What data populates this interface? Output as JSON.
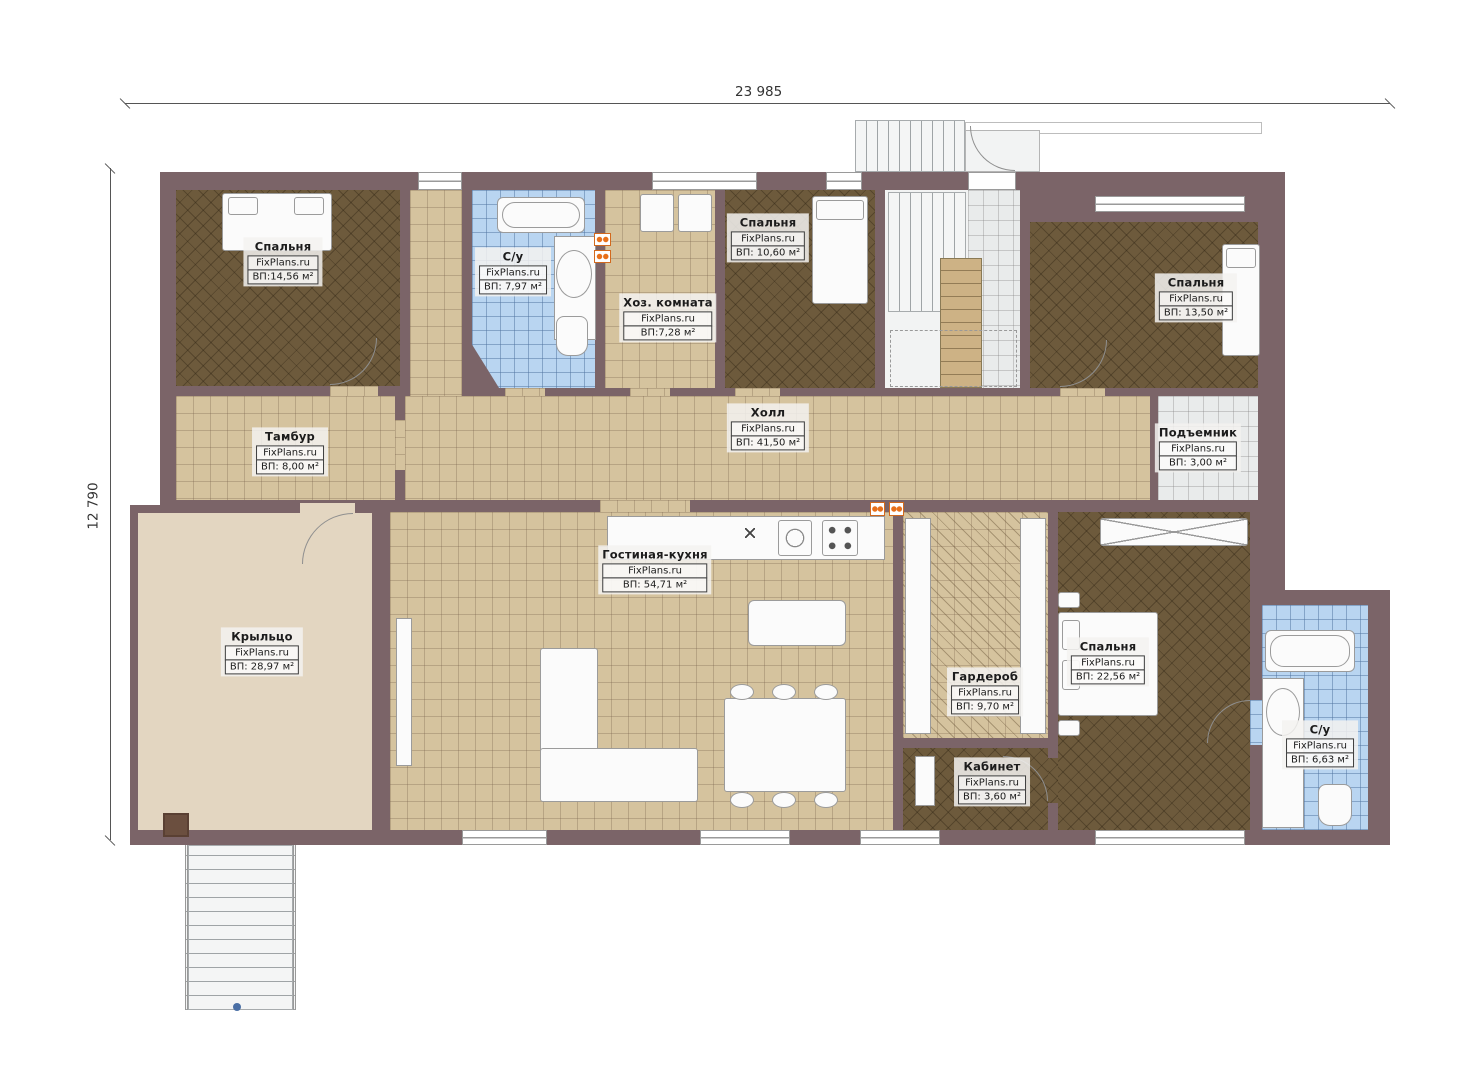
{
  "dimensions": {
    "width_label": "23 985",
    "height_label": "12 790"
  },
  "rooms": [
    {
      "name": "Спальня",
      "site": "FixPlans.ru",
      "area": "ВП:14,56 м²"
    },
    {
      "name": "С/у",
      "site": "FixPlans.ru",
      "area": "ВП: 7,97 м²"
    },
    {
      "name": "Хоз. комната",
      "site": "FixPlans.ru",
      "area": "ВП:7,28 м²"
    },
    {
      "name": "Спальня",
      "site": "FixPlans.ru",
      "area": "ВП: 10,60 м²"
    },
    {
      "name": "Спальня",
      "site": "FixPlans.ru",
      "area": "ВП: 13,50 м²"
    },
    {
      "name": "Тамбур",
      "site": "FixPlans.ru",
      "area": "ВП: 8,00 м²"
    },
    {
      "name": "Холл",
      "site": "FixPlans.ru",
      "area": "ВП: 41,50 м²"
    },
    {
      "name": "Подъемник",
      "site": "FixPlans.ru",
      "area": "ВП: 3,00 м²"
    },
    {
      "name": "Крыльцо",
      "site": "FixPlans.ru",
      "area": "ВП: 28,97 м²"
    },
    {
      "name": "Гостиная-кухня",
      "site": "FixPlans.ru",
      "area": "ВП: 54,71 м²"
    },
    {
      "name": "Гардероб",
      "site": "FixPlans.ru",
      "area": "ВП: 9,70 м²"
    },
    {
      "name": "Кабинет",
      "site": "FixPlans.ru",
      "area": "ВП: 3,60 м²"
    },
    {
      "name": "Спальня",
      "site": "FixPlans.ru",
      "area": "ВП: 22,56 м²"
    },
    {
      "name": "С/у",
      "site": "FixPlans.ru",
      "area": "ВП: 6,63 м²"
    }
  ],
  "colors": {
    "wall": "#7b6468",
    "tile_beige": "#d5c39e",
    "parquet_brown": "#6d5a3c",
    "tile_blue": "#b9d5f1",
    "porch": "#e3d6c1",
    "accent_orange": "#e8701a"
  }
}
